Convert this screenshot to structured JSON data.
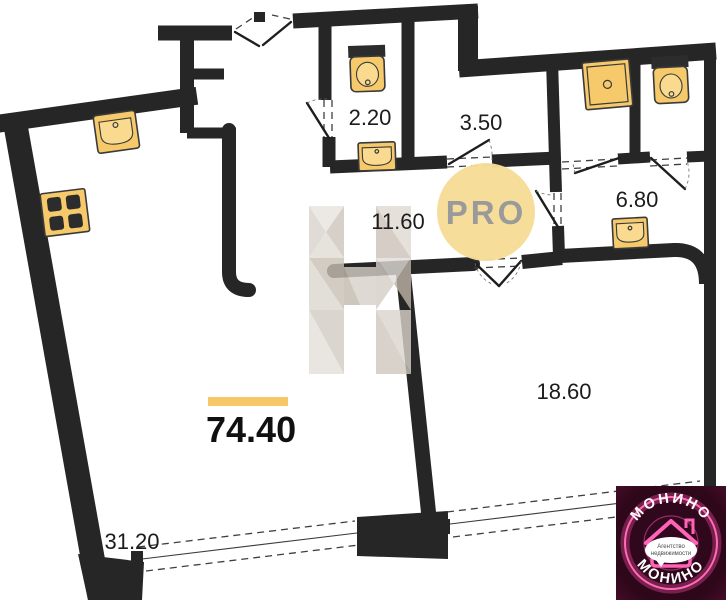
{
  "plan": {
    "total": {
      "area": "74.40"
    },
    "rooms": {
      "bathroom": {
        "area": "2.20"
      },
      "storage": {
        "area": "3.50"
      },
      "hallway": {
        "area": "11.60"
      },
      "washroom": {
        "area": "6.80"
      },
      "bedroom": {
        "area": "18.60"
      },
      "living_kitchen": {
        "area": "31.20"
      }
    },
    "badge": {
      "label": "PRO"
    },
    "watermark_letter": "Н",
    "icons": [
      "kitchen-sink-icon",
      "stove-icon",
      "toilet-icon",
      "hand-sink-icon",
      "shower-tray-icon",
      "wash-sink-icon",
      "entrance-door-icon",
      "house-icon"
    ]
  },
  "logo": {
    "arc_top": "МОНИНО",
    "arc_bottom": "МОНИНО",
    "subtitle_line1": "Агентство",
    "subtitle_line2": "недвижимости"
  },
  "colors": {
    "wall": "#262626",
    "fixture_fill": "#F6C96B",
    "fixture_inner": "#F9DA8F",
    "badge_bg": "#F6DC96",
    "badge_text": "#9A9A9A",
    "total_bar": "#F6C867",
    "logo_bg": "#2E0719",
    "logo_pink": "#FF4FA8"
  }
}
